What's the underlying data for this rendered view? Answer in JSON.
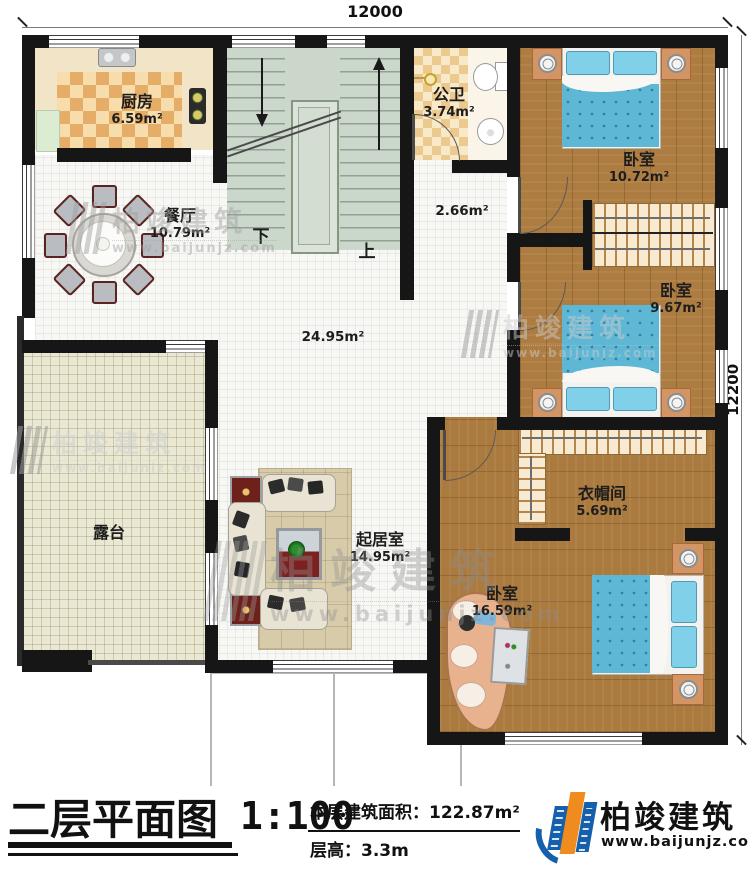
{
  "dimensions": {
    "top": "12000",
    "right": "12200"
  },
  "rooms": {
    "kitchen": {
      "name": "厨房",
      "area": "6.59m²"
    },
    "dining": {
      "name": "餐厅",
      "area": "10.79m²"
    },
    "bathroom": {
      "name": "公卫",
      "area": "3.74m²"
    },
    "bedroom_top": {
      "name": "卧室",
      "area": "10.72m²"
    },
    "hallway": {
      "area": "2.66m²"
    },
    "bedroom_mid": {
      "name": "卧室",
      "area": "9.67m²"
    },
    "open_area": {
      "area": "24.95m²"
    },
    "closet": {
      "name": "衣帽间",
      "area": "5.69m²"
    },
    "terrace": {
      "name": "露台"
    },
    "living": {
      "name": "起居室",
      "area": "14.95m²"
    },
    "bedroom_bottom": {
      "name": "卧室",
      "area": "16.59m²"
    }
  },
  "stairs": {
    "down": "下",
    "up": "上"
  },
  "titleblock": {
    "title": "二层平面图",
    "scale": "1:100",
    "area_label": "本层建筑面积：",
    "area_value": "122.87m²",
    "floor_height_label": "层高：",
    "floor_height_value": "3.3m"
  },
  "brand": {
    "name": "柏竣建筑",
    "url": "www.baijunjz.com"
  }
}
